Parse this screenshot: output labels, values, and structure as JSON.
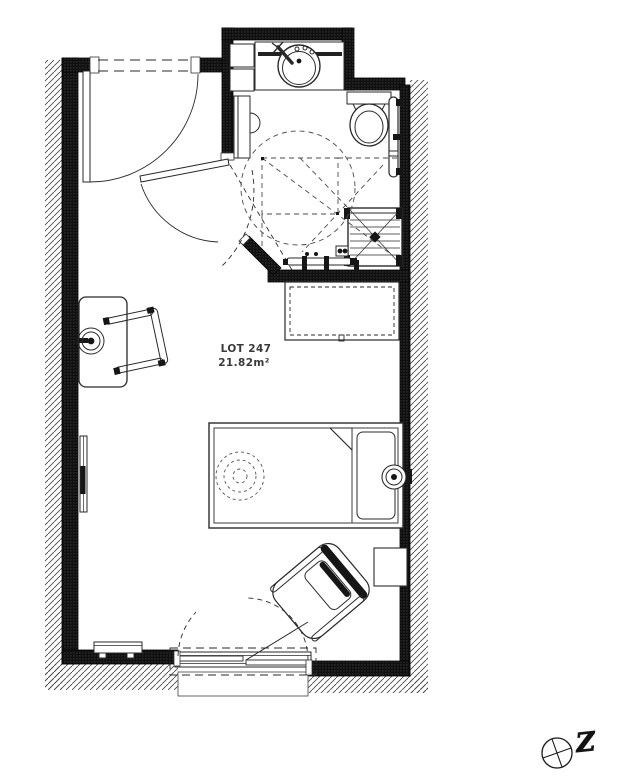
{
  "plan": {
    "lot_label": "LOT 247",
    "area_label": "21.82m²"
  },
  "compass": {
    "letter": "Z"
  },
  "colors": {
    "background": "#ffffff",
    "wall_fill": "#141414",
    "ink": "#2a2a2a",
    "hatch_line": "#4a4a4a",
    "dashed_line": "#4a4a4a",
    "label_text": "#3a3a3a"
  }
}
